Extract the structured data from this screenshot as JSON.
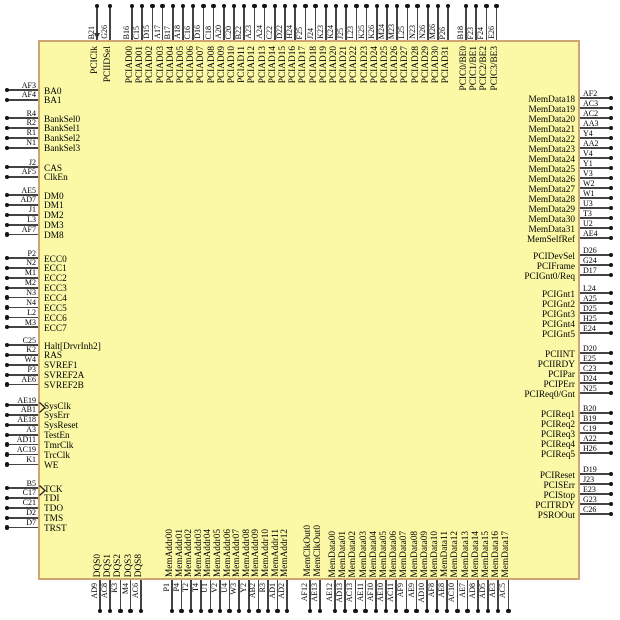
{
  "diagram": {
    "kind": "chip-pinout",
    "background": "#ffffff",
    "chip_fill": "#fbf9a6",
    "chip_border": "#cfa573",
    "pin_line_color": "#444444",
    "pin_dot_color": "#151515",
    "text_color": "#000000"
  },
  "pins": {
    "top": [
      [
        {
          "num": "B21",
          "label": "PCIClk",
          "clock": true
        },
        {
          "num": "G26",
          "label": "PCIIDSel"
        }
      ],
      [
        {
          "num": "B16",
          "label": "PCIAD00"
        },
        {
          "num": "C15",
          "label": "PCIAD01"
        },
        {
          "num": "D15",
          "label": "PCIAD02"
        },
        {
          "num": "A17",
          "label": "PCIAD03"
        },
        {
          "num": "B17",
          "label": "PCIAD04"
        },
        {
          "num": "A18",
          "label": "PCIAD05"
        },
        {
          "num": "C16",
          "label": "PCIAD06"
        },
        {
          "num": "D16",
          "label": "PCIAD07"
        },
        {
          "num": "C18",
          "label": "PCIAD08"
        },
        {
          "num": "A20",
          "label": "PCIAD09"
        },
        {
          "num": "C20",
          "label": "PCIAD10"
        },
        {
          "num": "B22",
          "label": "PCIAD11"
        },
        {
          "num": "A23",
          "label": "PCIAD12"
        },
        {
          "num": "A24",
          "label": "PCIAD13"
        },
        {
          "num": "C22",
          "label": "PCIAD14"
        },
        {
          "num": "D22",
          "label": "PCIAD15"
        },
        {
          "num": "H24",
          "label": "PCIAD16"
        },
        {
          "num": "F25",
          "label": "PCIAD17"
        },
        {
          "num": "J24",
          "label": "PCIAD18"
        },
        {
          "num": "K23",
          "label": "PCIAD19"
        },
        {
          "num": "K24",
          "label": "PCIAD20"
        },
        {
          "num": "J25",
          "label": "PCIAD21"
        },
        {
          "num": "L23",
          "label": "PCIAD22"
        },
        {
          "num": "K25",
          "label": "PCIAD23"
        },
        {
          "num": "K26",
          "label": "PCIAD24"
        },
        {
          "num": "M24",
          "label": "PCIAD25"
        },
        {
          "num": "M23",
          "label": "PCIAD26"
        },
        {
          "num": "L25",
          "label": "PCIAD27"
        },
        {
          "num": "N23",
          "label": "PCIAD28"
        },
        {
          "num": "N26",
          "label": "PCIAD29"
        },
        {
          "num": "M26",
          "label": "PCIAD30"
        },
        {
          "num": "P26",
          "label": "PCIAD31"
        }
      ],
      [
        {
          "num": "B18",
          "label": "PCIC0/BE0"
        },
        {
          "num": "F23",
          "label": "PCIC1/BE1"
        },
        {
          "num": "F24",
          "label": "PCIC2/BE2"
        },
        {
          "num": "E26",
          "label": "PCIC3/BE3"
        }
      ]
    ],
    "bottom": [
      [
        {
          "num": "AD9",
          "label": "DQS0"
        },
        {
          "num": "AC8",
          "label": "DQS1"
        },
        {
          "num": "K3",
          "label": "DQS2"
        },
        {
          "num": "M4",
          "label": "DQS3"
        },
        {
          "num": "AC6",
          "label": "DQS8"
        }
      ],
      [
        {
          "num": "P1",
          "label": "MemAddr00"
        },
        {
          "num": "P4",
          "label": "MemAddr01"
        },
        {
          "num": "T2",
          "label": "MemAddr02"
        },
        {
          "num": "T4",
          "label": "MemAddr03"
        },
        {
          "num": "U1",
          "label": "MemAddr04"
        },
        {
          "num": "V2",
          "label": "MemAddr05"
        },
        {
          "num": "U4",
          "label": "MemAddr06"
        },
        {
          "num": "W3",
          "label": "MemAddr07"
        },
        {
          "num": "Y2",
          "label": "MemAddr08"
        },
        {
          "num": "AB2",
          "label": "MemAddr09"
        },
        {
          "num": "R3",
          "label": "MemAddr10"
        },
        {
          "num": "AD1",
          "label": "MemAddr11"
        },
        {
          "num": "AD2",
          "label": "MemAddr12"
        }
      ],
      [
        {
          "num": "AF12",
          "label": "MemClkOut0"
        },
        {
          "num": "AE13",
          "label": "MemClkOut0"
        }
      ],
      [
        {
          "num": "AE12",
          "label": "MemData00"
        },
        {
          "num": "AD13",
          "label": "MemData01"
        },
        {
          "num": "AC13",
          "label": "MemData02"
        },
        {
          "num": "AE11",
          "label": "MemData03"
        },
        {
          "num": "AF10",
          "label": "MemData04"
        },
        {
          "num": "AE10",
          "label": "MemData05"
        },
        {
          "num": "AC11",
          "label": "MemData06"
        },
        {
          "num": "AF9",
          "label": "MemData07"
        },
        {
          "num": "AE9",
          "label": "MemData08"
        },
        {
          "num": "AD10",
          "label": "MemData09"
        },
        {
          "num": "AF8",
          "label": "MemData10"
        },
        {
          "num": "AE8",
          "label": "MemData11"
        },
        {
          "num": "AC10",
          "label": "MemData12"
        },
        {
          "num": "AE7",
          "label": "MemData13"
        },
        {
          "num": "AD8",
          "label": "MemData14"
        },
        {
          "num": "AD5",
          "label": "MemData15"
        },
        {
          "num": "AE3",
          "label": "MemData16"
        },
        {
          "num": "AC5",
          "label": "MemData17"
        }
      ]
    ],
    "left": [
      [
        {
          "num": "AF3",
          "label": "BA0"
        },
        {
          "num": "AF4",
          "label": "BA1"
        }
      ],
      [
        {
          "num": "R4",
          "label": "BankSel0"
        },
        {
          "num": "R2",
          "label": "BankSel1"
        },
        {
          "num": "R1",
          "label": "BankSel2"
        },
        {
          "num": "N1",
          "label": "BankSel3"
        }
      ],
      [
        {
          "num": "J2",
          "label": "CAS"
        },
        {
          "num": "AF5",
          "label": "ClkEn"
        }
      ],
      [
        {
          "num": "AE5",
          "label": "DM0"
        },
        {
          "num": "AD7",
          "label": "DM1"
        },
        {
          "num": "J1",
          "label": "DM2"
        },
        {
          "num": "L3",
          "label": "DM3"
        },
        {
          "num": "AF7",
          "label": "DM8"
        }
      ],
      [
        {
          "num": "P2",
          "label": "ECC0"
        },
        {
          "num": "N2",
          "label": "ECC1"
        },
        {
          "num": "M1",
          "label": "ECC2"
        },
        {
          "num": "M2",
          "label": "ECC3"
        },
        {
          "num": "N3",
          "label": "ECC4"
        },
        {
          "num": "N4",
          "label": "ECC5"
        },
        {
          "num": "L2",
          "label": "ECC6"
        },
        {
          "num": "M3",
          "label": "ECC7"
        }
      ],
      [
        {
          "num": "C25",
          "label": "Halt[DrvrInh2]"
        },
        {
          "num": "K2",
          "label": "RAS"
        },
        {
          "num": "W4",
          "label": "SVREF1"
        },
        {
          "num": "P3",
          "label": "SVREF2A"
        },
        {
          "num": "AE6",
          "label": "SVREF2B"
        }
      ],
      [
        {
          "num": "AE19",
          "label": "SysClk",
          "clock": true
        },
        {
          "num": "AB1",
          "label": "SysErr"
        },
        {
          "num": "AE18",
          "label": "SysReset"
        },
        {
          "num": "A3",
          "label": "TestEn"
        },
        {
          "num": "AD11",
          "label": "TmrClk"
        },
        {
          "num": "AC19",
          "label": "TrcClk"
        },
        {
          "num": "K1",
          "label": "WE"
        }
      ],
      [
        {
          "num": "B5",
          "label": "TCK",
          "clock": true
        },
        {
          "num": "C17",
          "label": "TDI"
        },
        {
          "num": "C21",
          "label": "TDO"
        },
        {
          "num": "D2",
          "label": "TMS"
        },
        {
          "num": "D7",
          "label": "TRST"
        }
      ]
    ],
    "right": [
      [
        {
          "num": "AF2",
          "label": "MemData18"
        },
        {
          "num": "AC3",
          "label": "MemData19"
        },
        {
          "num": "AC2",
          "label": "MemData20"
        },
        {
          "num": "AA3",
          "label": "MemData21"
        },
        {
          "num": "Y4",
          "label": "MemData22"
        },
        {
          "num": "AA2",
          "label": "MemData23"
        },
        {
          "num": "V4",
          "label": "MemData24"
        },
        {
          "num": "Y1",
          "label": "MemData25"
        },
        {
          "num": "V3",
          "label": "MemData26"
        },
        {
          "num": "W2",
          "label": "MemData27"
        },
        {
          "num": "W1",
          "label": "MemData28"
        },
        {
          "num": "U3",
          "label": "MemData29"
        },
        {
          "num": "T3",
          "label": "MemData30"
        },
        {
          "num": "U2",
          "label": "MemData31"
        },
        {
          "num": "AE4",
          "label": "MemSelfRef"
        }
      ],
      [
        {
          "num": "D26",
          "label": "PCIDevSel"
        },
        {
          "num": "G24",
          "label": "PCIFrame"
        },
        {
          "num": "D17",
          "label": "PCIGnt0/Req"
        }
      ],
      [
        {
          "num": "L24",
          "label": "PCIGnt1"
        },
        {
          "num": "A25",
          "label": "PCIGnt2"
        },
        {
          "num": "D25",
          "label": "PCIGnt3"
        },
        {
          "num": "H25",
          "label": "PCIGnt4"
        },
        {
          "num": "E24",
          "label": "PCIGnt5"
        }
      ],
      [
        {
          "num": "D20",
          "label": "PCIINT"
        },
        {
          "num": "E25",
          "label": "PCIIRDY"
        },
        {
          "num": "C23",
          "label": "PCIPar"
        },
        {
          "num": "D24",
          "label": "PCIPErr"
        },
        {
          "num": "N25",
          "label": "PCIReq0/Gnt"
        }
      ],
      [
        {
          "num": "B20",
          "label": "PCIReq1"
        },
        {
          "num": "B19",
          "label": "PCIReq2"
        },
        {
          "num": "C19",
          "label": "PCIReq3"
        },
        {
          "num": "A22",
          "label": "PCIReq4"
        },
        {
          "num": "H26",
          "label": "PCIReq5"
        }
      ],
      [
        {
          "num": "D19",
          "label": "PCIReset"
        },
        {
          "num": "J23",
          "label": "PCISErr"
        },
        {
          "num": "E23",
          "label": "PCIStop"
        },
        {
          "num": "G23",
          "label": "PCITRDY"
        },
        {
          "num": "C26",
          "label": "PSROOut"
        }
      ]
    ]
  }
}
